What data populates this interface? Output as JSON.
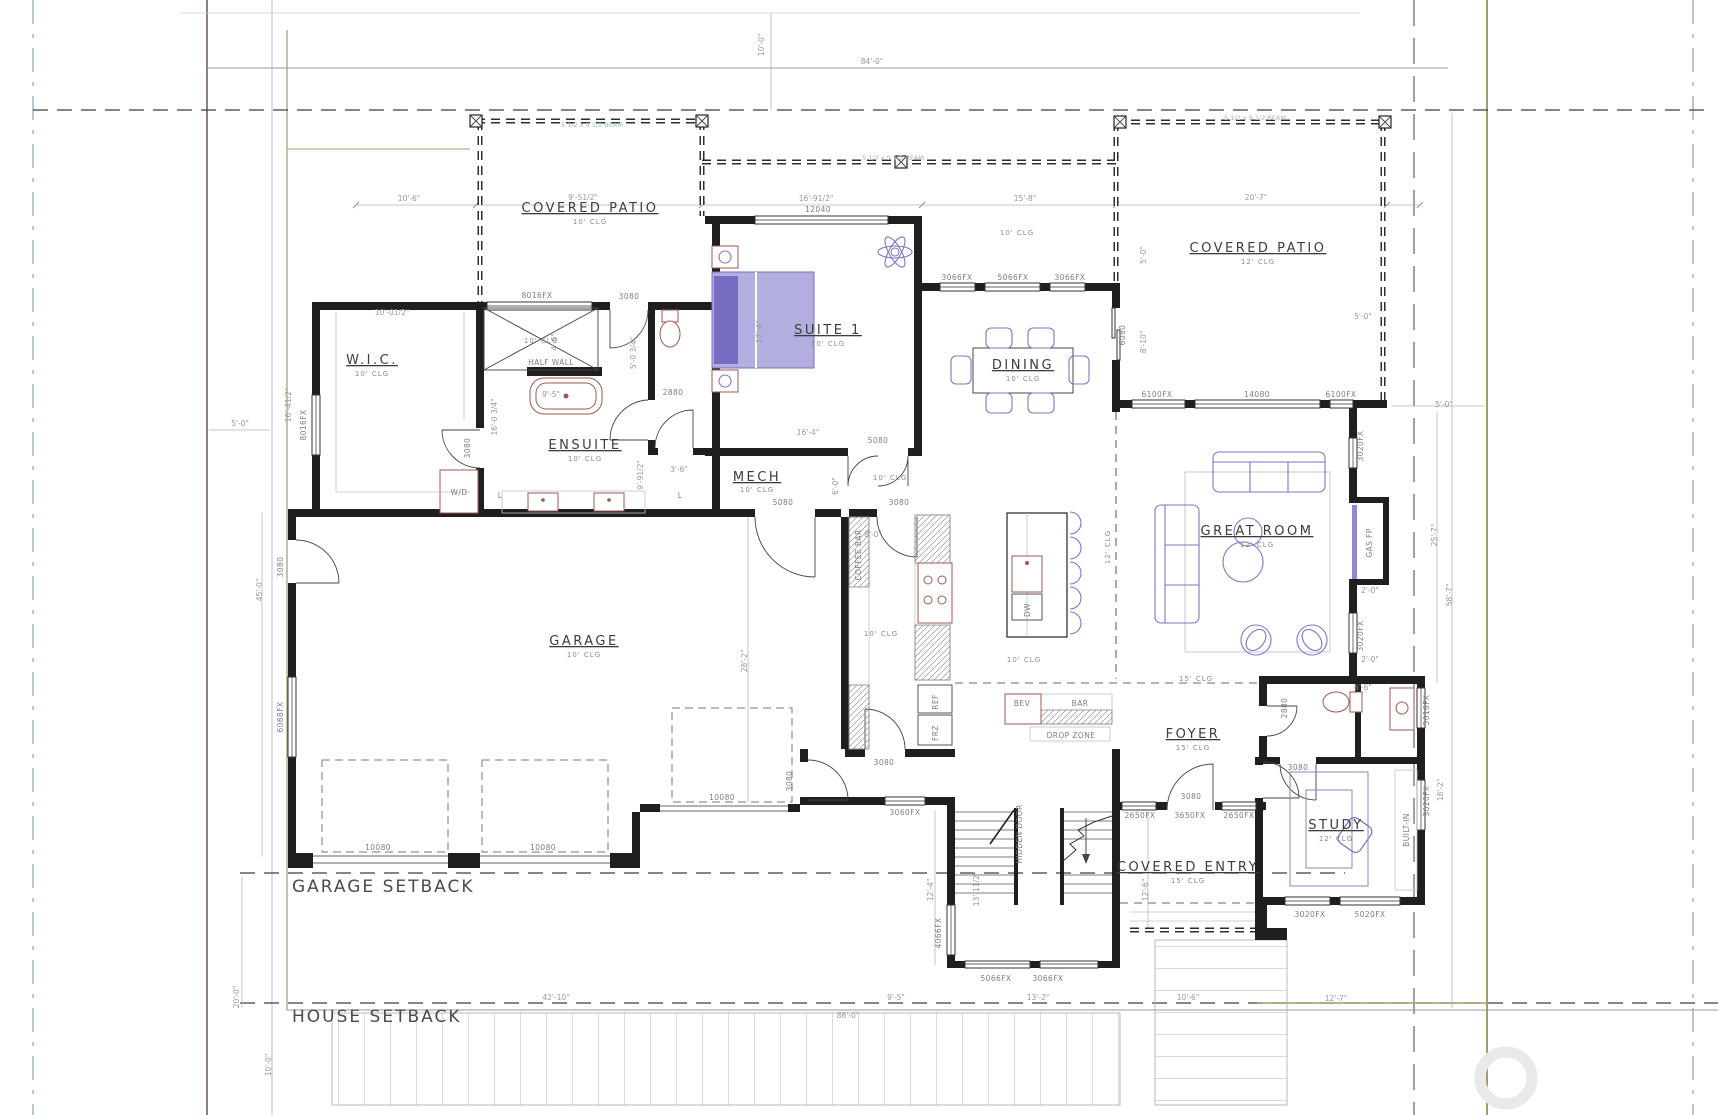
{
  "sheet": {
    "width": 1721,
    "height": 1115
  },
  "rooms": [
    {
      "label": "COVERED PATIO",
      "clg": "10' CLG"
    },
    {
      "label": "SUITE 1",
      "clg": "10' CLG"
    },
    {
      "label": "DINING",
      "clg": "10' CLG"
    },
    {
      "label": "COVERED PATIO",
      "clg": "12' CLG"
    },
    {
      "label": "W.I.C.",
      "clg": "10' CLG"
    },
    {
      "label": "ENSUITE",
      "clg": "10' CLG"
    },
    {
      "label": "MECH",
      "clg": "10' CLG"
    },
    {
      "label": "GREAT ROOM",
      "clg": "12' CLG"
    },
    {
      "label": "GARAGE",
      "clg": "10' CLG"
    },
    {
      "label": "FOYER",
      "clg": "15' CLG"
    },
    {
      "label": "STUDY",
      "clg": "12' CLG"
    },
    {
      "label": "COVERED ENTRY",
      "clg": "15' CLG"
    }
  ],
  "setbacks": {
    "garage": "GARAGE SETBACK",
    "house": "HOUSE SETBACK"
  },
  "windows": [
    "8016FX",
    "8016FX",
    "12040",
    "3066FX",
    "5066FX",
    "3066FX",
    "6100FX",
    "14080",
    "6100FX",
    "3020FX",
    "3020FX",
    "6068FX",
    "10080",
    "10080",
    "10080",
    "3060FX",
    "4066FX",
    "5066FX",
    "3066FX",
    "2650FX",
    "3650FX",
    "2650FX",
    "3020FX",
    "5020FX",
    "3020FX",
    "5016FX"
  ],
  "doors": [
    "3080",
    "3080",
    "2880",
    "5080",
    "5080",
    "3080",
    "3080",
    "3080",
    "6080",
    "3080",
    "2880",
    "3080",
    "3080"
  ],
  "dims": [
    "84'-0\"",
    "10'-0\"",
    "10'-6\"",
    "9'-51/2\"",
    "16'-91/2\"",
    "15'-8\"",
    "20'-7\"",
    "5'-0\"",
    "16'-41/2\"",
    "10'-01/2\"",
    "4'-6\"",
    "9'-5\"",
    "16'-0 3/4\"",
    "9'-91/2\"",
    "5'-0 3/4\"",
    "3'-6\"",
    "17'-4\"",
    "16'-4\"",
    "6'-0\"",
    "8'-0\"",
    "5'-0\"",
    "8'-10\"",
    "5'-0\"",
    "5'-0\"",
    "25'-7\"",
    "58'-7\"",
    "2'-0\"",
    "2'-0\"",
    "6'-6\"",
    "18'-2\"",
    "28'-2\"",
    "45'-0\"",
    "12'-4\"",
    "13'-11/2\"",
    "12'-6\"",
    "20'-0\"",
    "10'-0\"",
    "42'-10\"",
    "88'-0\"",
    "9'-5\"",
    "13'-2\"",
    "10'-6\"",
    "12'-7\""
  ],
  "annotations": {
    "half_wall": "HALF WALL",
    "coffee_bar": "COFFEE BAR",
    "ref": "REF",
    "frz": "FRZ",
    "bev": "BEV",
    "bar": "BAR",
    "drop_zone": "DROP ZONE",
    "dw": "DW",
    "wd": "W/D",
    "gas_fp": "GAS FP",
    "built_in": "BUILT-IN",
    "hidden_door": "HIDDEN DOOR",
    "linen": "L",
    "beam": "5 1/2 x 9 1/2 BEAM"
  },
  "ceiling_notes": [
    "10' CLG",
    "10' CLG",
    "10' CLG",
    "10' CLG",
    "15' CLG",
    "10' CLG",
    "12' CLG"
  ]
}
